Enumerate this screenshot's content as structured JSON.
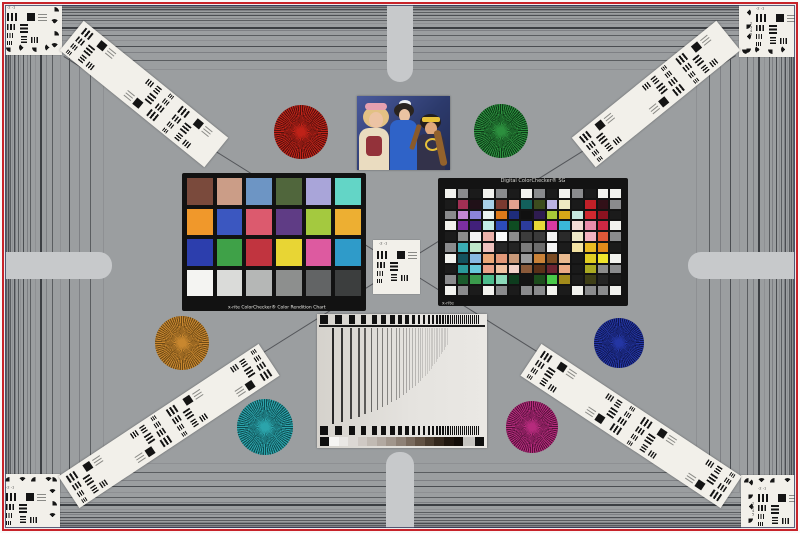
{
  "scene": {
    "name": "lens-test-chart",
    "background": "#9b9ea0",
    "border_red": "#c7232a",
    "capsule_color": "#c7c9cb",
    "frame_line_colors": [
      "#5a5d60",
      "#8e9093",
      "#4a4d51",
      "#7e8084"
    ]
  },
  "classic_checker": {
    "label": "x-rite ColorChecker® Color Rendition Chart",
    "rows": [
      [
        "#7a4a3c",
        "#cb9d87",
        "#6d95c4",
        "#50663c",
        "#a9a5d9",
        "#63d5c6"
      ],
      [
        "#f0982b",
        "#3b57c0",
        "#dc5a6e",
        "#5f3c85",
        "#a4c93f",
        "#edaf32"
      ],
      [
        "#2c3ead",
        "#3fa148",
        "#c1343f",
        "#e8d534",
        "#dd5aa0",
        "#2f9bc9"
      ],
      [
        "#f4f4f2",
        "#dadbd9",
        "#b5b7b6",
        "#8d8f8e",
        "#626465",
        "#3c3e3e"
      ]
    ]
  },
  "sg_checker": {
    "title": "Digital ColorChecker® SG",
    "brand": "x-rite",
    "tones": {
      "W": "#f2f2ee",
      "N": "#8a8b8d",
      "K": "#1b1b1b"
    },
    "rows": [
      [
        "W",
        "N",
        "K",
        "W",
        "N",
        "K",
        "W",
        "N",
        "K",
        "W",
        "N",
        "K",
        "W",
        "W"
      ],
      [
        "K",
        "#a03054",
        "#201018",
        "#a8cfe8",
        "#7a3a30",
        "#e2a28e",
        "#12605c",
        "#3c4c1e",
        "#bab2e2",
        "#eeeac2",
        "#1a1a1a",
        "#c22028",
        "#321018",
        "N"
      ],
      [
        "N",
        "#c387d3",
        "#8b84da",
        "#e9f1ef",
        "#de7a1a",
        "#1e2c7c",
        "#101010",
        "#2e1c50",
        "#a9c838",
        "#d8a818",
        "#c6e8e0",
        "#d02830",
        "#8c1220",
        "K"
      ],
      [
        "W",
        "#7b2fa0",
        "#41207a",
        "#c2ece9",
        "#2c4cba",
        "#0e4c22",
        "#2c3c9c",
        "#e8d838",
        "#d83aa2",
        "#3ab8d8",
        "#f2dcd4",
        "#ea8cab",
        "#d02844",
        "W"
      ],
      [
        "K",
        "#8c8c8c",
        "#f4f4f4",
        "#ecb2aa",
        "#fbfbfb",
        "#8c8c8c",
        "#3c3c3c",
        "#3a3a3a",
        "#f2f2f2",
        "#2a2a2a",
        "#ece8c8",
        "#f2b2c0",
        "#e05838",
        "N"
      ],
      [
        "N",
        "#3aacb4",
        "#bee8ca",
        "#eec2be",
        "#262626",
        "#242424",
        "#7a7a7a",
        "#6c6c6c",
        "#f4f4f4",
        "#1c1c1c",
        "#f2e2a2",
        "#eaba22",
        "#e28a1a",
        "K"
      ],
      [
        "W",
        "#14525e",
        "#88bae2",
        "#eaa878",
        "#e29878",
        "#c89878",
        "#9a9a9a",
        "#ca8238",
        "#7a4a22",
        "#eaba90",
        "#1a1a1a",
        "#e2ce22",
        "#f0e42c",
        "W"
      ],
      [
        "K",
        "#2a9a9a",
        "#66cada",
        "#eaa28a",
        "#f0c2a2",
        "#f2d2ca",
        "#8a5a3a",
        "#5a3018",
        "#6c2432",
        "#ecaa84",
        "#1a1a1a",
        "#aaaa22",
        "#8c8c8c",
        "N"
      ],
      [
        "N",
        "#1a5a2c",
        "#3a9a4c",
        "#4cbc8c",
        "#8cdaba",
        "#0e3c1e",
        "#141414",
        "#1c4c1c",
        "#4aca4a",
        "#a28a1a",
        "#1c1c1c",
        "#3e3e16",
        "#242424",
        "K"
      ],
      [
        "W",
        "N",
        "K",
        "W",
        "N",
        "K",
        "N",
        "N",
        "W",
        "K",
        "W",
        "N",
        "N",
        "W"
      ]
    ]
  },
  "stars": [
    {
      "name": "red",
      "x": 301,
      "y": 132,
      "r": 27,
      "color": "#bf2218",
      "dark": "#54100c"
    },
    {
      "name": "green",
      "x": 501,
      "y": 131,
      "r": 27,
      "color": "#2c8f3e",
      "dark": "#0c3a16"
    },
    {
      "name": "ochre",
      "x": 182,
      "y": 343,
      "r": 27,
      "color": "#c8872f",
      "dark": "#6e4a16"
    },
    {
      "name": "teal",
      "x": 265,
      "y": 427,
      "r": 28,
      "color": "#2ba4ab",
      "dark": "#0f4d52"
    },
    {
      "name": "blue",
      "x": 619,
      "y": 343,
      "r": 25,
      "color": "#2436a4",
      "dark": "#0e1650"
    },
    {
      "name": "magenta",
      "x": 532,
      "y": 427,
      "r": 26,
      "color": "#b62b7d",
      "dark": "#55123a"
    }
  ],
  "center_card": {
    "labels": [
      "-2",
      "-1"
    ]
  },
  "corner_cards": {
    "top_labels": [
      "-2",
      "-1"
    ],
    "side_labels": [
      "2",
      "3",
      "4",
      "5"
    ]
  },
  "grayscale_ramp": [
    "#f6f5f3",
    "#e9e7e4",
    "#dcd8d4",
    "#cfc9c4",
    "#c1bab3",
    "#b2a9a1",
    "#a1968c",
    "#8e8176",
    "#796a5d",
    "#625244",
    "#4a3c2f",
    "#33271c",
    "#1f160e",
    "#120c07"
  ]
}
